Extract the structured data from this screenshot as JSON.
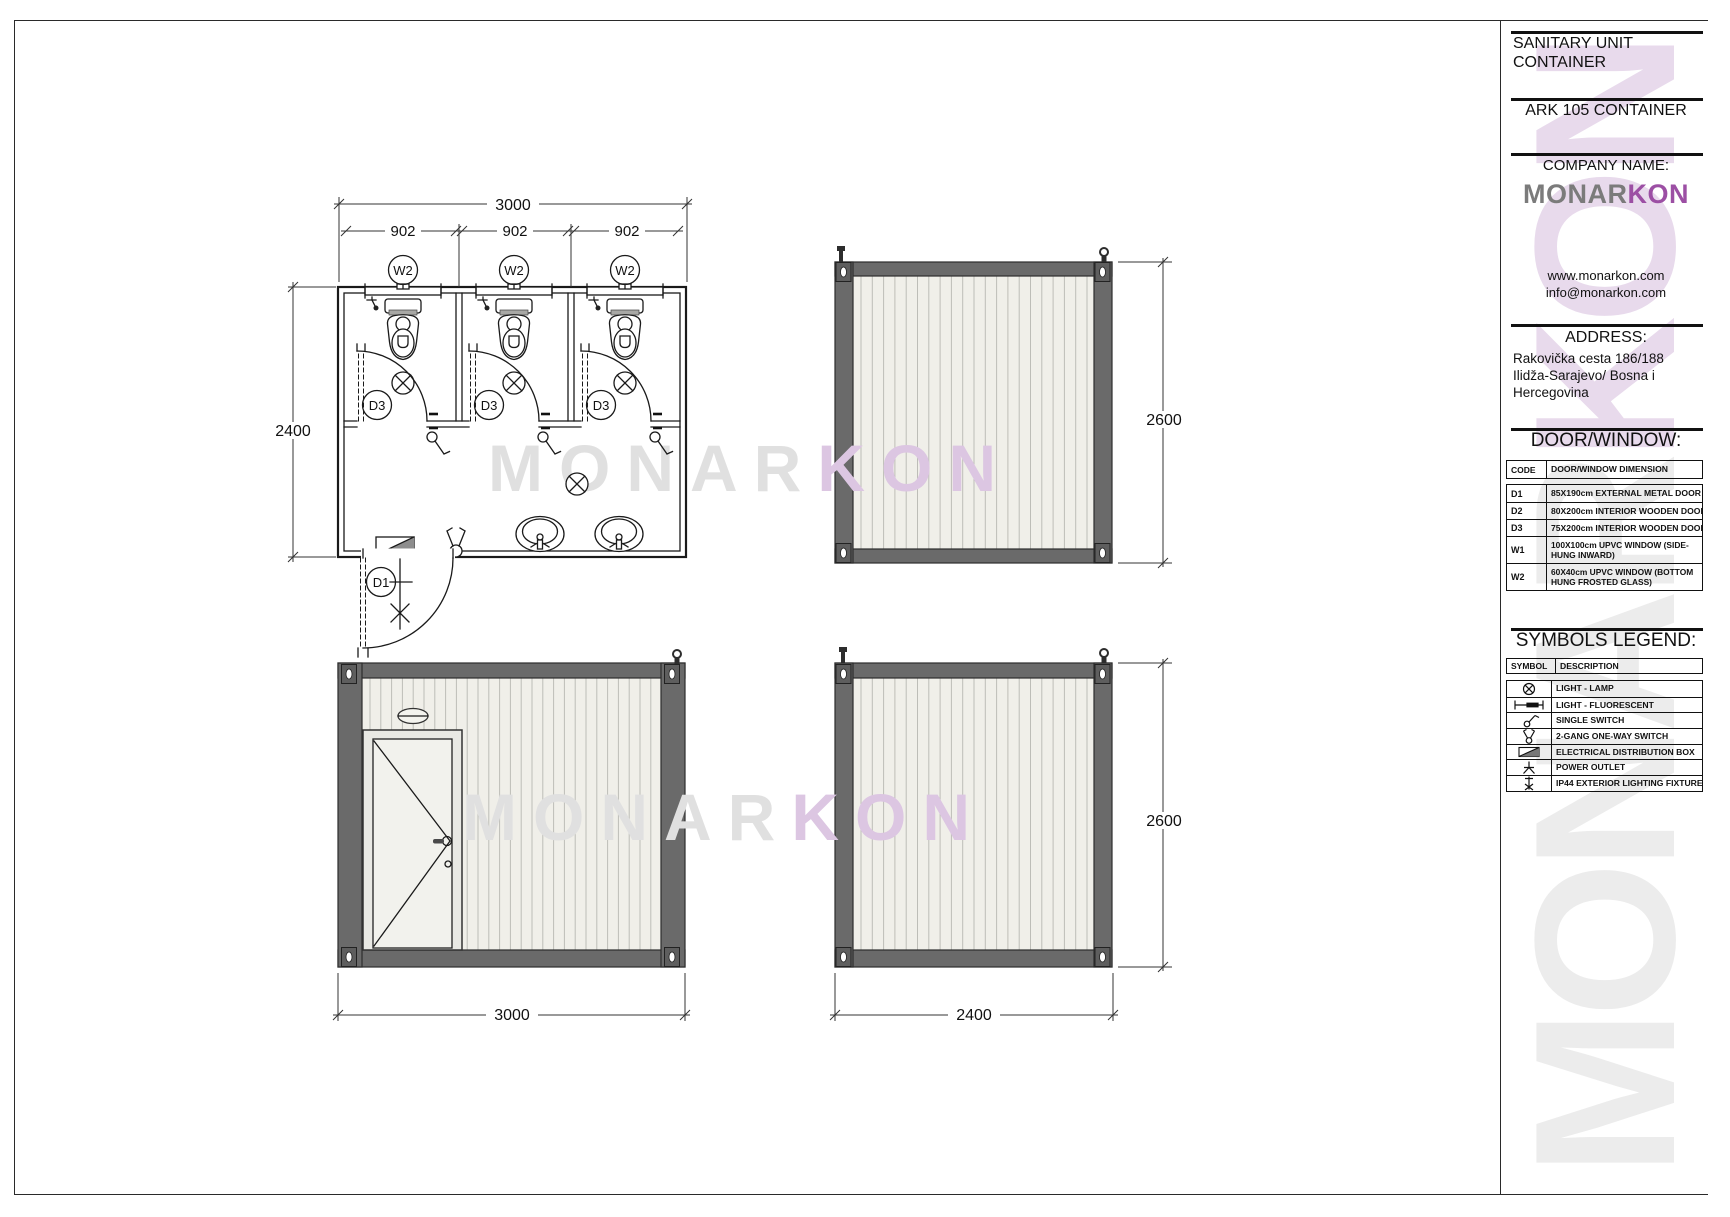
{
  "title_block": {
    "project_title": "SANITARY UNIT CONTAINER",
    "product_name": "ARK 105 CONTAINER",
    "company_label": "COMPANY NAME:",
    "logo_part1": "MONAR",
    "logo_part2": "KON",
    "website": "www.monarkon.com",
    "email": "info@monarkon.com",
    "address_label": "ADDRESS:",
    "address_line1": "Rakovička cesta 186/188",
    "address_line2": "Ilidža-Sarajevo/ Bosna i",
    "address_line3": "Hercegovina",
    "colors": {
      "logo_gray": "#7b7b7b",
      "logo_purple": "#9c4fa4",
      "frame_gray": "#6a6a6a",
      "wall_offwhite": "#f0efe9"
    },
    "door_window": {
      "section_title": "DOOR/WINDOW:",
      "col1": "CODE",
      "col2": "DOOR/WINDOW DIMENSION",
      "rows": [
        {
          "code": "D1",
          "desc": "85X190cm EXTERNAL METAL DOOR"
        },
        {
          "code": "D2",
          "desc": "80X200cm INTERIOR WOODEN DOOR"
        },
        {
          "code": "D3",
          "desc": "75X200cm INTERIOR WOODEN DOOR"
        },
        {
          "code": "W1",
          "desc": "100X100cm UPVC WINDOW (SIDE-HUNG INWARD)"
        },
        {
          "code": "W2",
          "desc": "60X40cm UPVC WINDOW (BOTTOM HUNG FROSTED GLASS)"
        }
      ]
    },
    "symbols_legend": {
      "section_title": "SYMBOLS LEGEND:",
      "col1": "SYMBOL",
      "col2": "DESCRIPTION",
      "rows": [
        {
          "icon": "lamp-light-icon",
          "desc": "LIGHT - LAMP"
        },
        {
          "icon": "fluorescent-light-icon",
          "desc": "LIGHT - FLUORESCENT"
        },
        {
          "icon": "single-switch-icon",
          "desc": "SINGLE SWITCH"
        },
        {
          "icon": "two-gang-switch-icon",
          "desc": "2-GANG ONE-WAY SWITCH"
        },
        {
          "icon": "distribution-box-icon",
          "desc": "ELECTRICAL DISTRIBUTION BOX"
        },
        {
          "icon": "power-outlet-icon",
          "desc": "POWER OUTLET"
        },
        {
          "icon": "exterior-light-icon",
          "desc": "IP44 EXTERIOR LIGHTING FIXTURE"
        }
      ]
    }
  },
  "drawing": {
    "dims": {
      "plan_width": "3000",
      "stall_widths": [
        "902",
        "902",
        "902"
      ],
      "plan_depth": "2400",
      "side_height": "2600",
      "front_width": "3000",
      "rear_height": "2600",
      "rear_width": "2400"
    },
    "labels": {
      "window": "W2",
      "stall_door": "D3",
      "entry_door": "D1"
    },
    "watermark_part1": "MONAR",
    "watermark_part2": "KON"
  }
}
